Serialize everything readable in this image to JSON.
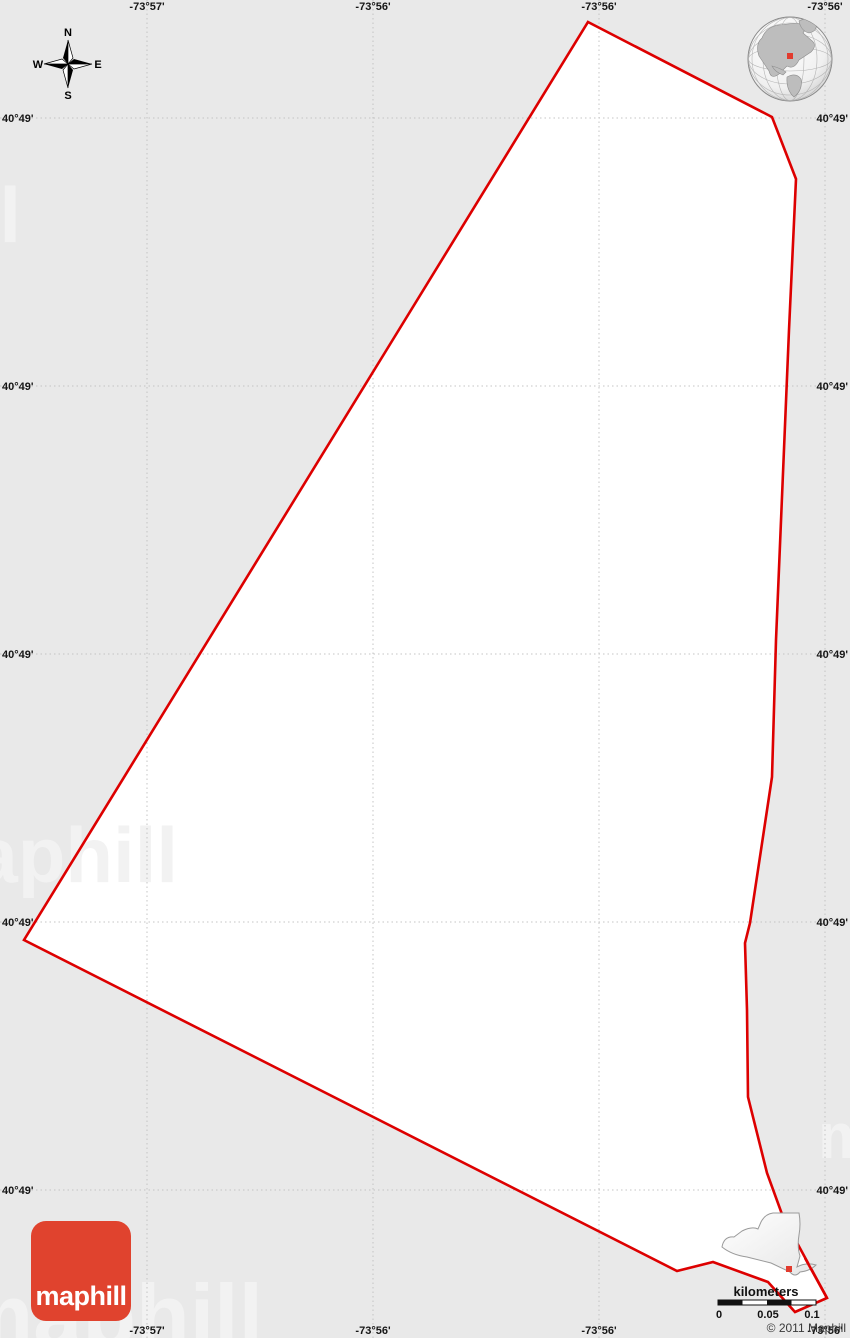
{
  "map": {
    "background_color": "#e9e9e9",
    "area_fill_color": "#ffffff",
    "boundary_color": "#dd0000",
    "boundary_points": [
      [
        588,
        22
      ],
      [
        772,
        117
      ],
      [
        796,
        179
      ],
      [
        789,
        330
      ],
      [
        776,
        640
      ],
      [
        772,
        777
      ],
      [
        750,
        923
      ],
      [
        745,
        943
      ],
      [
        747,
        1010
      ],
      [
        748,
        1097
      ],
      [
        767,
        1173
      ],
      [
        783,
        1217
      ],
      [
        827,
        1298
      ],
      [
        795,
        1312
      ],
      [
        768,
        1282
      ],
      [
        713,
        1262
      ],
      [
        677,
        1271
      ],
      [
        24,
        940
      ]
    ]
  },
  "grid": {
    "top_labels": [
      "-73°57'",
      "-73°56'",
      "-73°56'",
      "-73°56'"
    ],
    "bottom_labels": [
      "-73°57'",
      "-73°56'",
      "-73°56'",
      "-73°56'"
    ],
    "left_labels": [
      "40°49'",
      "40°49'",
      "40°49'",
      "40°49'",
      "40°49'"
    ],
    "right_labels": [
      "40°49'",
      "40°49'",
      "40°49'",
      "40°49'",
      "40°49'"
    ]
  },
  "compass": {
    "north": "N",
    "south": "S",
    "east": "E",
    "west": "W"
  },
  "scale_bar": {
    "title": "kilometers",
    "ticks": [
      "0",
      "0.05",
      "0.1"
    ]
  },
  "inset": {
    "marker_color": "#e23b2e"
  },
  "globe": {
    "marker_color": "#e23b2e"
  },
  "branding": {
    "logo_text": "maphill",
    "logo_color": "#e0432e",
    "copyright": "© 2011 Maphill",
    "watermark": "maphill"
  }
}
